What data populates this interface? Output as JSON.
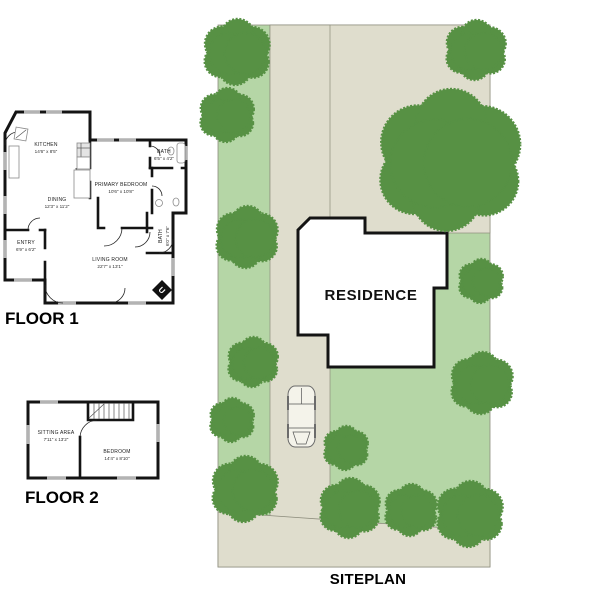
{
  "floor1": {
    "title": "FLOOR 1",
    "rooms": {
      "kitchen": {
        "name": "KITCHEN",
        "dims": "14'6\" x 8'5\""
      },
      "dining": {
        "name": "DINING",
        "dims": "12'3\" x 11'2\""
      },
      "entry": {
        "name": "ENTRY",
        "dims": "6'9\" x 6'2\""
      },
      "living": {
        "name": "LIVING ROOM",
        "dims": "22'7\" x 13'1\""
      },
      "primary": {
        "name": "PRIMARY BEDROOM",
        "dims": "10'6\" x 10'8\""
      },
      "bath1": {
        "name": "BATH",
        "dims": "6'5\" x 4'2\""
      },
      "bath2": {
        "name": "BATH",
        "dims": "6'0\" x 7'6\""
      }
    }
  },
  "floor2": {
    "title": "FLOOR 2",
    "rooms": {
      "sitting": {
        "name": "SITTING AREA",
        "dims": "7'11\" x 13'2\""
      },
      "bedroom": {
        "name": "BEDROOM",
        "dims": "14'4\" x 8'10\""
      }
    }
  },
  "siteplan": {
    "title": "SITEPLAN",
    "residence_label": "RESIDENCE",
    "colors": {
      "lot": "#b5d6a6",
      "paving": "#dfddcd",
      "tree": "#579144",
      "outline": "#8d8d7d"
    },
    "trees": [
      {
        "x": 237,
        "y": 52,
        "r": 33
      },
      {
        "x": 227,
        "y": 115,
        "r": 27
      },
      {
        "x": 247,
        "y": 237,
        "r": 31
      },
      {
        "x": 253,
        "y": 362,
        "r": 25
      },
      {
        "x": 232,
        "y": 420,
        "r": 22
      },
      {
        "x": 245,
        "y": 489,
        "r": 33
      },
      {
        "x": 346,
        "y": 448,
        "r": 22
      },
      {
        "x": 350,
        "y": 508,
        "r": 30
      },
      {
        "x": 411,
        "y": 510,
        "r": 26
      },
      {
        "x": 470,
        "y": 514,
        "r": 33
      },
      {
        "x": 476,
        "y": 50,
        "r": 30
      },
      {
        "x": 450,
        "y": 160,
        "r": 71
      },
      {
        "x": 481,
        "y": 281,
        "r": 22
      },
      {
        "x": 482,
        "y": 383,
        "r": 31
      }
    ]
  }
}
